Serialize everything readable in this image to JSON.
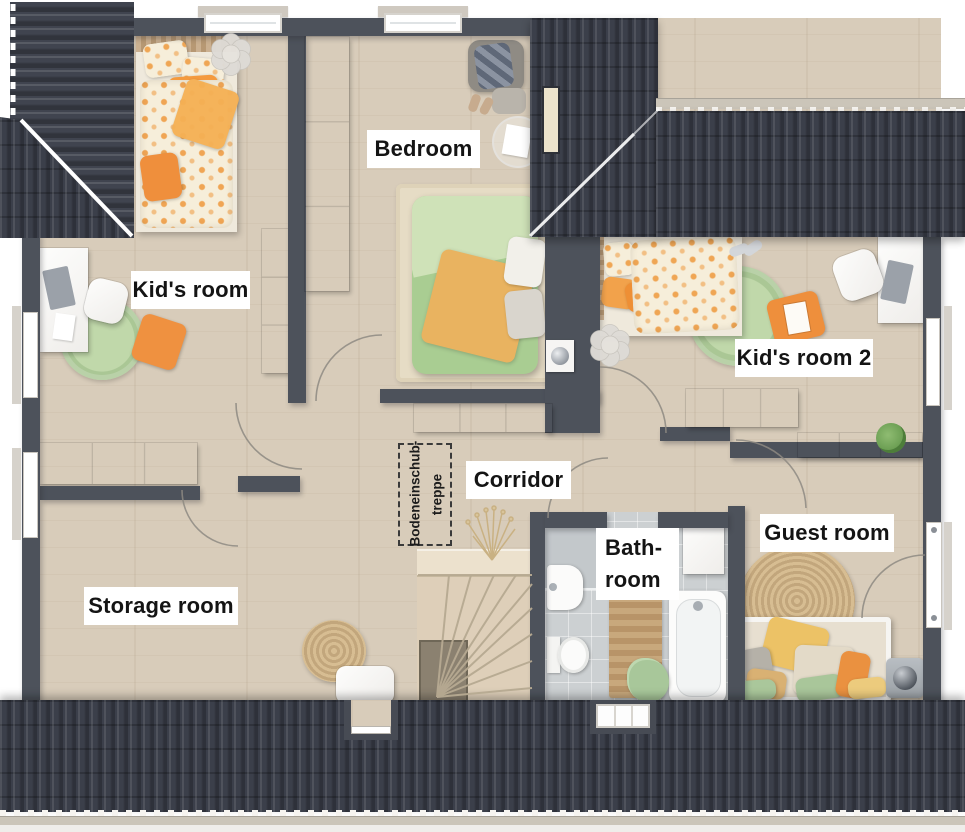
{
  "floorplan": {
    "rooms": {
      "bedroom": {
        "label": "Bedroom"
      },
      "kids_room": {
        "label": "Kid's room"
      },
      "kids_room_2": {
        "label": "Kid's room 2"
      },
      "corridor": {
        "label": "Corridor"
      },
      "storage_room": {
        "label": "Storage room"
      },
      "bathroom": {
        "line1": "Bath-",
        "line2": "room"
      },
      "guest_room": {
        "label": "Guest room"
      }
    },
    "annotations": {
      "attic_ladder": {
        "line1": "Bodeneinschub-",
        "line2": "treppe"
      }
    },
    "colors": {
      "roof": "#3b3f4a",
      "wall": "#4d525b",
      "wood_floor": "#d8ccba",
      "tile_floor": "#ccd0d2",
      "label_bg": "#ffffff",
      "label_text": "#141414",
      "accent_orange": "#ee9040",
      "accent_green": "#b7d2a1"
    }
  }
}
